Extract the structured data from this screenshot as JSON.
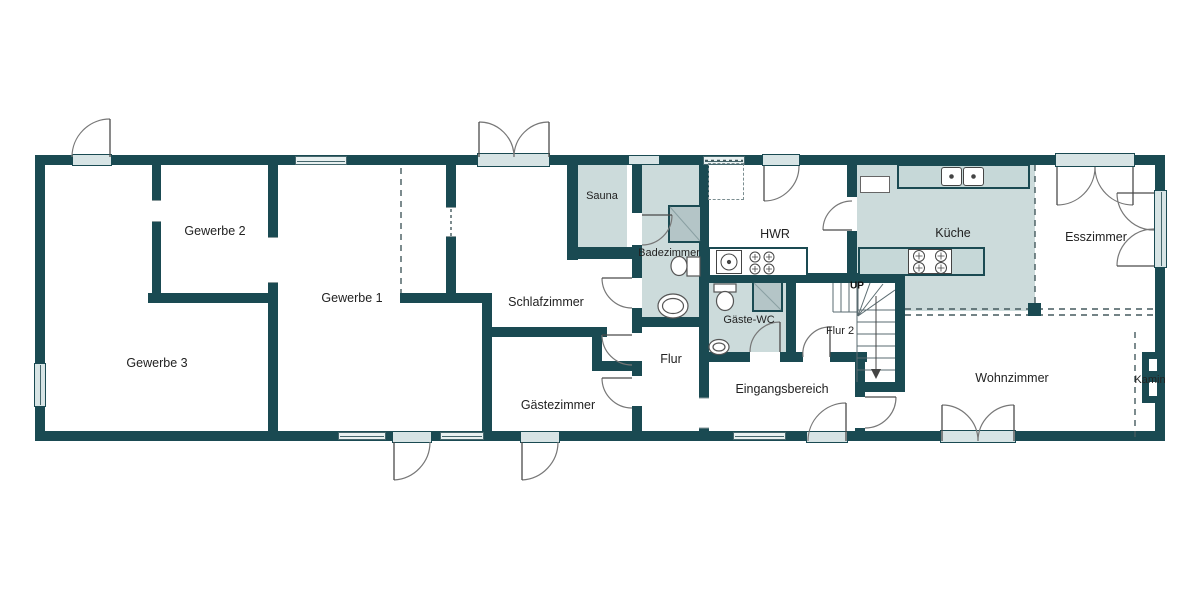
{
  "colors": {
    "wall": "#1a4a52",
    "wet_room_fill": "#ccdbdb",
    "counter_fill": "#c6d8d8",
    "slab_fill": "#d7e4e5",
    "background": "#ffffff"
  },
  "rooms": {
    "gewerbe_1": {
      "label": "Gewerbe 1"
    },
    "gewerbe_2": {
      "label": "Gewerbe 2"
    },
    "gewerbe_3": {
      "label": "Gewerbe 3"
    },
    "schlafzimmer": {
      "label": "Schlafzimmer"
    },
    "sauna": {
      "label": "Sauna"
    },
    "badezimmer": {
      "label": "Badezimmer"
    },
    "hwr": {
      "label": "HWR"
    },
    "kueche": {
      "label": "Küche"
    },
    "esszimmer": {
      "label": "Esszimmer"
    },
    "gaeste_wc": {
      "label": "Gäste-WC"
    },
    "flur": {
      "label": "Flur"
    },
    "flur_2": {
      "label": "Flur 2"
    },
    "gaestezimmer": {
      "label": "Gästezimmer"
    },
    "eingangsbereich": {
      "label": "Eingangsbereich"
    },
    "wohnzimmer": {
      "label": "Wohnzimmer"
    },
    "kamin": {
      "label": "Kamin"
    }
  },
  "stairs": {
    "direction_label": "UP"
  }
}
